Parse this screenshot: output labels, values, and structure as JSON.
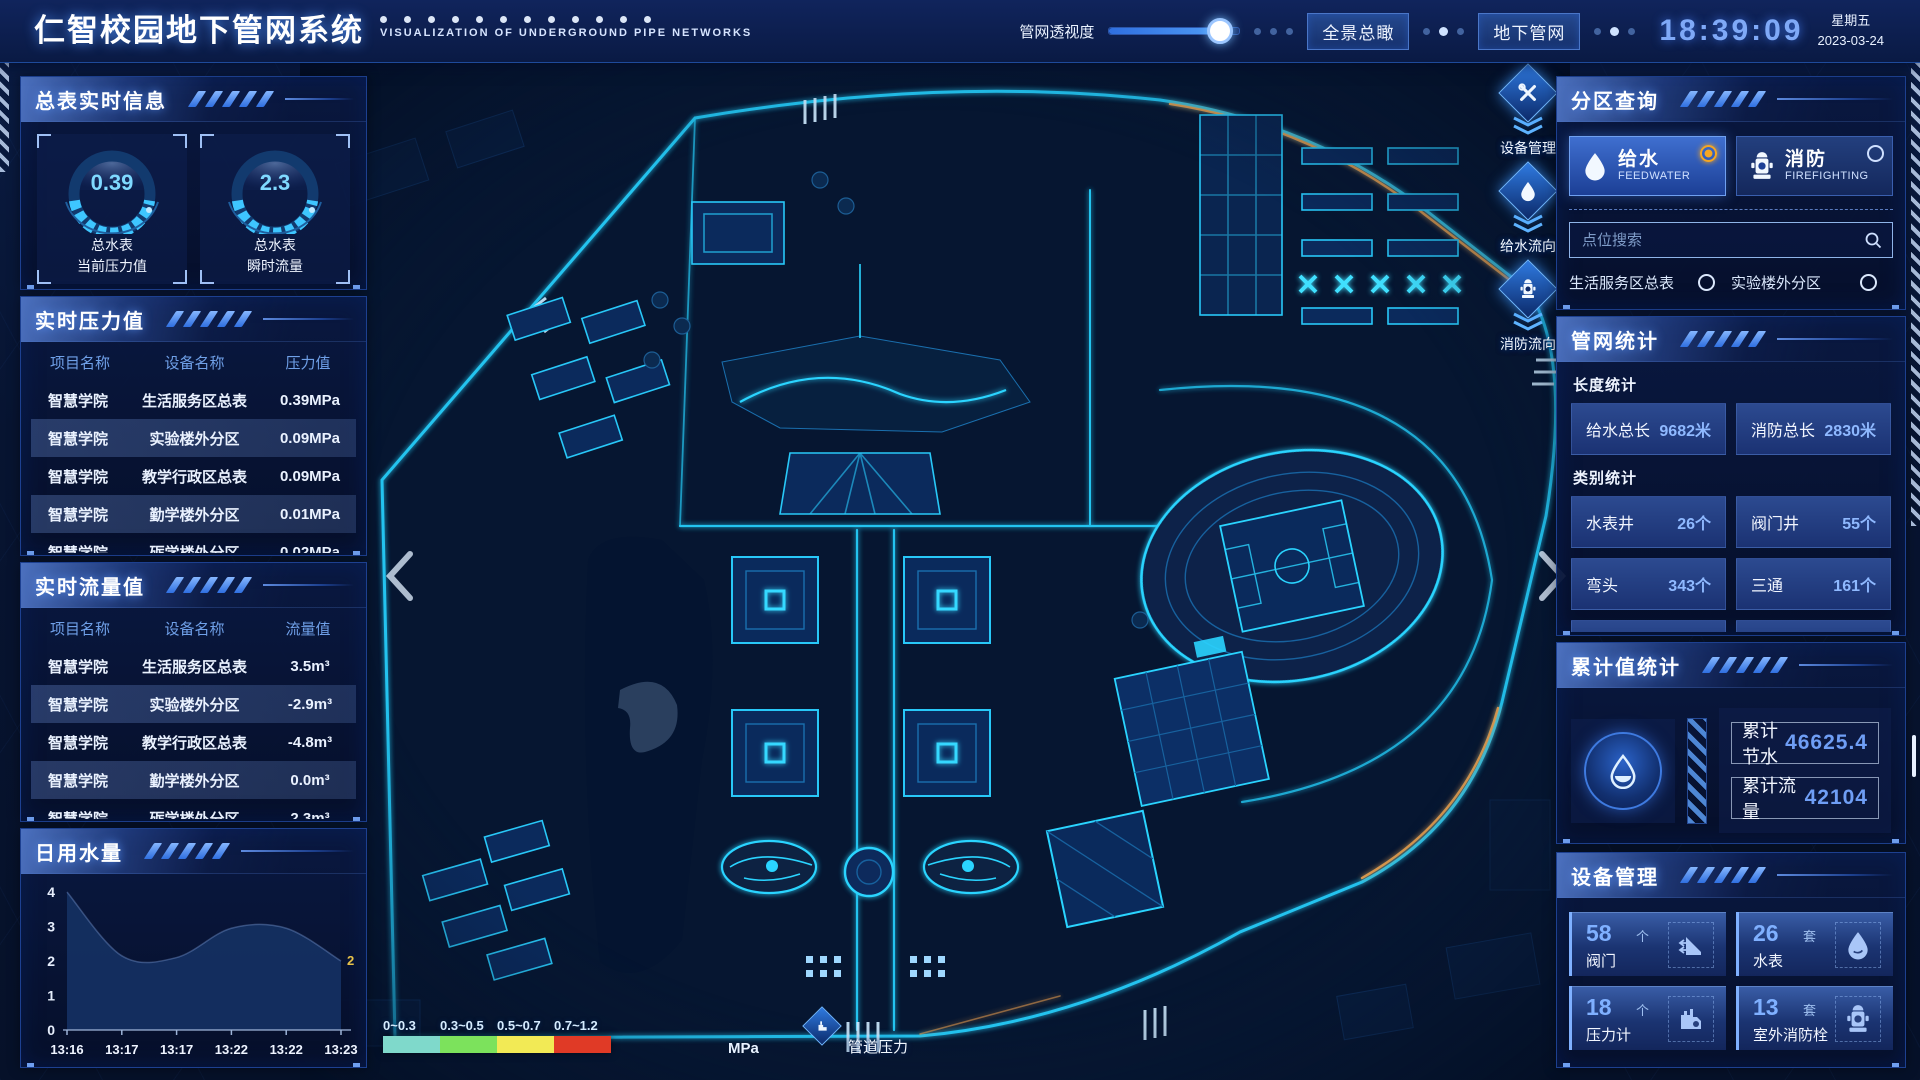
{
  "header": {
    "title": "仁智校园地下管网系统",
    "subtitle": "VISUALIZATION OF UNDERGROUND PIPE NETWORKS",
    "opacity_label": "管网透视度",
    "slider_percent": 85,
    "btn_overview": "全景总瞰",
    "btn_underground": "地下管网",
    "time": "18:39:09",
    "weekday": "星期五",
    "date": "2023-03-24"
  },
  "left": {
    "meter_info": {
      "title": "总表实时信息",
      "gauges": [
        {
          "value": "0.39",
          "line1": "总水表",
          "line2": "当前压力值"
        },
        {
          "value": "2.3",
          "line1": "总水表",
          "line2": "瞬时流量"
        }
      ]
    },
    "pressure": {
      "title": "实时压力值",
      "headers": [
        "项目名称",
        "设备名称",
        "压力值"
      ],
      "rows": [
        [
          "智慧学院",
          "生活服务区总表",
          "0.39MPa"
        ],
        [
          "智慧学院",
          "实验楼外分区",
          "0.09MPa"
        ],
        [
          "智慧学院",
          "教学行政区总表",
          "0.09MPa"
        ],
        [
          "智慧学院",
          "勤学楼外分区",
          "0.01MPa"
        ],
        [
          "智慧学院",
          "砺学楼外分区",
          "0.02MPa"
        ]
      ]
    },
    "flow": {
      "title": "实时流量值",
      "headers": [
        "项目名称",
        "设备名称",
        "流量值"
      ],
      "rows": [
        [
          "智慧学院",
          "生活服务区总表",
          "3.5m³"
        ],
        [
          "智慧学院",
          "实验楼外分区",
          "-2.9m³"
        ],
        [
          "智慧学院",
          "教学行政区总表",
          "-4.8m³"
        ],
        [
          "智慧学院",
          "勤学楼外分区",
          "0.0m³"
        ],
        [
          "智慧学院",
          "砺学楼外分区",
          "2.3m³"
        ]
      ]
    }
  },
  "chart_data": {
    "type": "area",
    "title": "日用水量",
    "x": [
      "13:16",
      "13:17",
      "13:17",
      "13:22",
      "13:22",
      "13:23"
    ],
    "values": [
      4,
      2.15,
      2.1,
      2.95,
      2.95,
      2
    ],
    "ylim": [
      0,
      4
    ],
    "yticks": [
      0,
      1,
      2,
      3,
      4
    ],
    "end_label": "2",
    "grid": false,
    "legend": "none"
  },
  "map": {
    "tools": [
      {
        "label": "设备管理",
        "icon": "wrench-icon"
      },
      {
        "label": "给水流向",
        "icon": "water-drop-icon"
      },
      {
        "label": "消防流向",
        "icon": "hydrant-icon"
      }
    ],
    "legend": {
      "ranges": [
        "0~0.3",
        "0.3~0.5",
        "0.5~0.7",
        "0.7~1.2"
      ],
      "colors": [
        "#7fd9cb",
        "#7ce25c",
        "#f2ea55",
        "#e03a26"
      ],
      "unit": "MPa",
      "label": "管道压力"
    }
  },
  "right": {
    "zone_query": {
      "title": "分区查询",
      "tabs": [
        {
          "name": "给水",
          "en": "FEEDWATER",
          "selected": true
        },
        {
          "name": "消防",
          "en": "FIREFIGHTING",
          "selected": false
        }
      ],
      "search_placeholder": "点位搜索",
      "items": [
        "生活服务区总表",
        "实验楼外分区",
        "教学行政区总表",
        "勤学楼外分区",
        "砺学楼外分区",
        "宿舍区泵房"
      ]
    },
    "pipe_stats": {
      "title": "管网统计",
      "length_label": "长度统计",
      "length_items": [
        {
          "name": "给水总长",
          "value": "9682米"
        },
        {
          "name": "消防总长",
          "value": "2830米"
        }
      ],
      "category_label": "类别统计",
      "category_items": [
        {
          "name": "水表井",
          "value": "26个"
        },
        {
          "name": "阀门井",
          "value": "55个"
        },
        {
          "name": "弯头",
          "value": "343个"
        },
        {
          "name": "三通",
          "value": "161个"
        }
      ]
    },
    "cumulative": {
      "title": "累计值统计",
      "items": [
        {
          "name": "累计节水",
          "value": "46625.4"
        },
        {
          "name": "累计流量",
          "value": "42104"
        }
      ]
    },
    "devices": {
      "title": "设备管理",
      "cards": [
        {
          "count": "58",
          "unit": "个",
          "name": "阀门",
          "icon": "valve-icon"
        },
        {
          "count": "26",
          "unit": "套",
          "name": "水表",
          "icon": "water-meter-icon"
        },
        {
          "count": "18",
          "unit": "个",
          "name": "压力计",
          "icon": "pressure-gauge-icon"
        },
        {
          "count": "13",
          "unit": "套",
          "name": "室外消防栓",
          "icon": "outdoor-hydrant-icon"
        }
      ]
    }
  }
}
